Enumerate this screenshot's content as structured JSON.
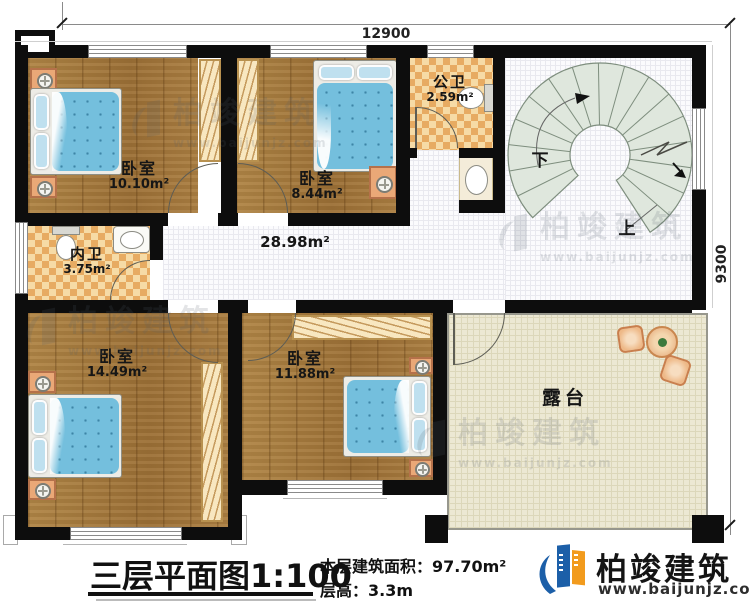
{
  "dim_top": "12900",
  "dim_right": "9300",
  "rooms": {
    "bedroom_top_left": {
      "name": "卧室",
      "area": "10.10m²"
    },
    "bedroom_top_mid": {
      "name": "卧室",
      "area": "8.44m²"
    },
    "public_bath": {
      "name": "公卫",
      "area": "2.59m²"
    },
    "private_bath": {
      "name": "内卫",
      "area": "3.75m²"
    },
    "hall": {
      "area": "28.98m²"
    },
    "bedroom_bottom_left": {
      "name": "卧室",
      "area": "14.49m²"
    },
    "bedroom_bottom_mid": {
      "name": "卧室",
      "area": "11.88m²"
    },
    "terrace": {
      "name": "露台"
    }
  },
  "stairs": {
    "down_label": "下",
    "up_label": "上"
  },
  "footer": {
    "title": "三层平面图",
    "scale": "1:100",
    "area_label": "本层建筑面积：",
    "area_value": "97.70m²",
    "height_label": "层高：",
    "height_value": "3.3m"
  },
  "brand": {
    "name": "柏竣建筑",
    "url": "www.baijunjz.com"
  },
  "watermark": {
    "name": "柏竣建筑",
    "url": "www.baijunjz.com"
  }
}
